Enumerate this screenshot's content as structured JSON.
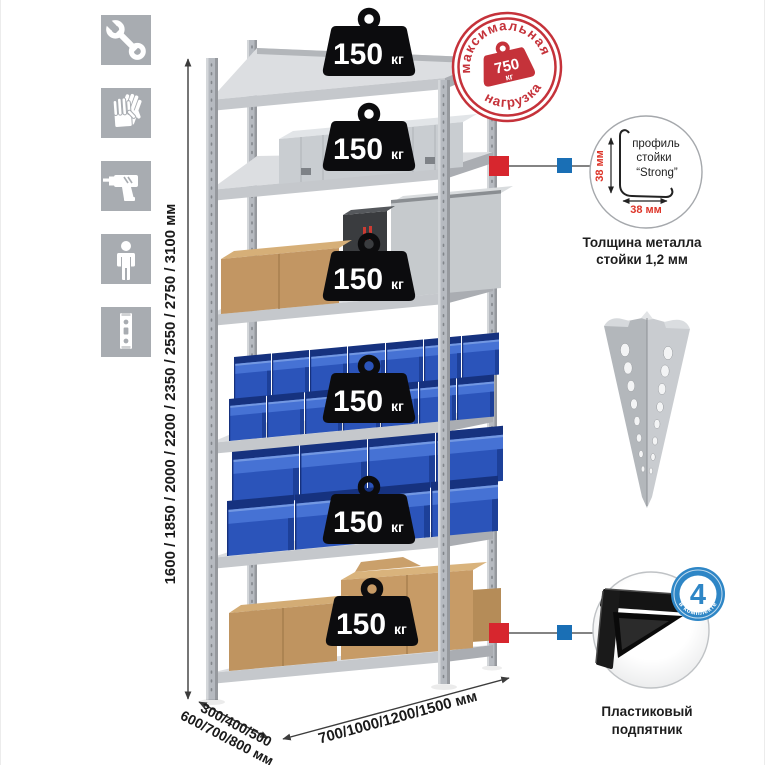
{
  "assembly_icons": [
    {
      "name": "wrench-icon"
    },
    {
      "name": "work-gloves-icon"
    },
    {
      "name": "drill-icon"
    },
    {
      "name": "person-icon"
    },
    {
      "name": "rack-post-icon"
    }
  ],
  "dimensions": {
    "height_options": "1600 / 1850 / 2000 / 2200 / 2350 / 2550 / 2750 / 3100 мм",
    "depth_options_line1": "300/400/500",
    "depth_options_line2": "600/700/800 мм",
    "width_options": "700/1000/1200/1500 мм"
  },
  "shelf_load_badge": {
    "value": "150",
    "unit": "кг"
  },
  "max_load_stamp": {
    "arc_top": "максимальная",
    "arc_bottom": "нагрузка",
    "value": "750",
    "unit": "кг"
  },
  "post_profile_detail": {
    "dim_vertical": "38 мм",
    "dim_horizontal": "38 мм",
    "label_line1": "профиль",
    "label_line2": "стойки",
    "label_line3": "“Strong”",
    "caption_line1": "Толщина металла",
    "caption_line2": "стойки 1,2 мм"
  },
  "foot_detail": {
    "badge_count": "4",
    "badge_arc_text": "в комплекте",
    "caption_line1": "Пластиковый",
    "caption_line2": "подпятник"
  },
  "colors": {
    "accent_red": "#c5323a",
    "connector_red": "#d7262e",
    "connector_blue": "#1a6fb5",
    "kit_badge_blue": "#2e86c6",
    "bin_blue": "#2b54ba",
    "metal_gray": "#b6bac0",
    "badge_black": "#0c0c0e",
    "cardboard": "#c09561"
  }
}
